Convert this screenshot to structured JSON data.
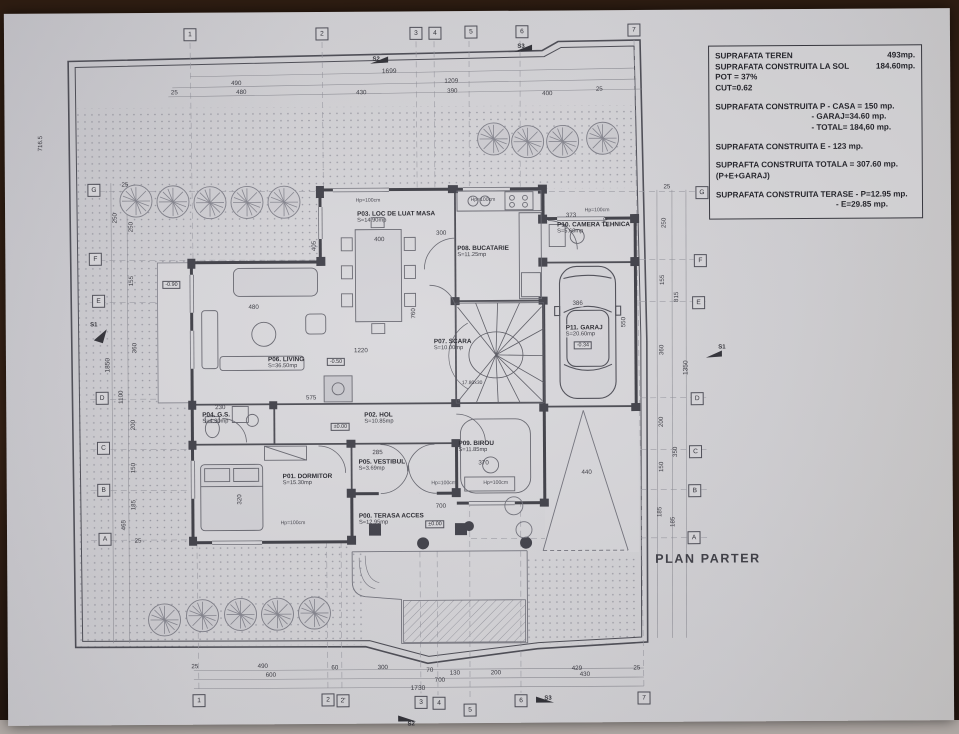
{
  "plan_title": "PLAN PARTER",
  "infobox": {
    "row0_label": "SUPRAFATA TEREN",
    "row0_value": "493mp.",
    "row1_label": "SUPRAFATA CONSTRUITA LA SOL",
    "row1_value": "184.60mp.",
    "row2": "POT = 37%",
    "row3": "CUT=0.62",
    "row4": "SUPRAFATA CONSTRUITA P - CASA = 150 mp.",
    "row5": "- GARAJ=34.60 mp.",
    "row6": "- TOTAL= 184,60 mp.",
    "row7": "SUPRAFATA CONSTRUITA E - 123 mp.",
    "row8": "SUPRAFTA CONSTRUITA TOTALA  = 307.60 mp.",
    "row9": "(P+E+GARAJ)",
    "row10": "SUPRAFATA CONSTRUITA TERASE - P=12.95 mp.",
    "row11": "- E=29.85 mp."
  },
  "rooms": [
    {
      "label": "P00. TERASA ACCES",
      "area": "S=12.95mp"
    },
    {
      "label": "P01. DORMITOR",
      "area": "S=15.30mp"
    },
    {
      "label": "P02. HOL",
      "area": "S=10.85mp"
    },
    {
      "label": "P03. LOC DE LUAT MASA",
      "area": "S=14.90mp"
    },
    {
      "label": "P04. G.S.",
      "area": "S=4.30mp"
    },
    {
      "label": "P05. VESTIBUL",
      "area": "S=3.69mp"
    },
    {
      "label": "P06. LIVING",
      "area": "S=36.50mp"
    },
    {
      "label": "P07. SCARA",
      "area": "S=10.00mp"
    },
    {
      "label": "P08. BUCATARIE",
      "area": "S=11.25mp"
    },
    {
      "label": "P09. BIROU",
      "area": "S=11.85mp"
    },
    {
      "label": "P10. CAMERA TEHNICA",
      "area": "S=5.60mp"
    },
    {
      "label": "P11. GARAJ",
      "area": "S=20.60mp"
    }
  ],
  "grid": {
    "top": [
      "1",
      "2",
      "3",
      "4",
      "5",
      "6",
      "7"
    ],
    "bottom": [
      "1",
      "2",
      "2'",
      "3",
      "4",
      "5",
      "6",
      "7"
    ],
    "left": [
      "G",
      "F",
      "E",
      "D",
      "C",
      "B",
      "A"
    ],
    "right": [
      "G",
      "F",
      "E",
      "D",
      "C",
      "B",
      "A"
    ]
  },
  "dims": {
    "top": [
      "1699",
      "490",
      "25",
      "480",
      "430",
      "1209",
      "390",
      "400",
      "25"
    ],
    "bottom": [
      "25",
      "490",
      "60",
      "300",
      "70",
      "130",
      "200",
      "429",
      "25",
      "600",
      "700",
      "430",
      "1730"
    ],
    "left": [
      "716.5",
      "25",
      "250",
      "250",
      "155",
      "360",
      "1850",
      "1100",
      "200",
      "150",
      "185",
      "465",
      "25"
    ],
    "right": [
      "25",
      "250",
      "155",
      "815",
      "360",
      "1350",
      "200",
      "350",
      "150",
      "185",
      "185"
    ],
    "inner": [
      "405",
      "400",
      "300",
      "373",
      "170",
      "386",
      "550",
      "480",
      "1220",
      "760",
      "575",
      "230",
      "320",
      "285",
      "370",
      "700",
      "440"
    ],
    "stair_note": "17.80x30"
  },
  "levels": {
    "hol": "±0.00",
    "terasa": "±0.00",
    "living": "-0.50",
    "garaj": "-0.34",
    "exterior": "-0.90"
  },
  "window_height_label": "Hp=100cm",
  "sections": {
    "s1": "S1",
    "s2": "S2",
    "s3": "S3"
  }
}
